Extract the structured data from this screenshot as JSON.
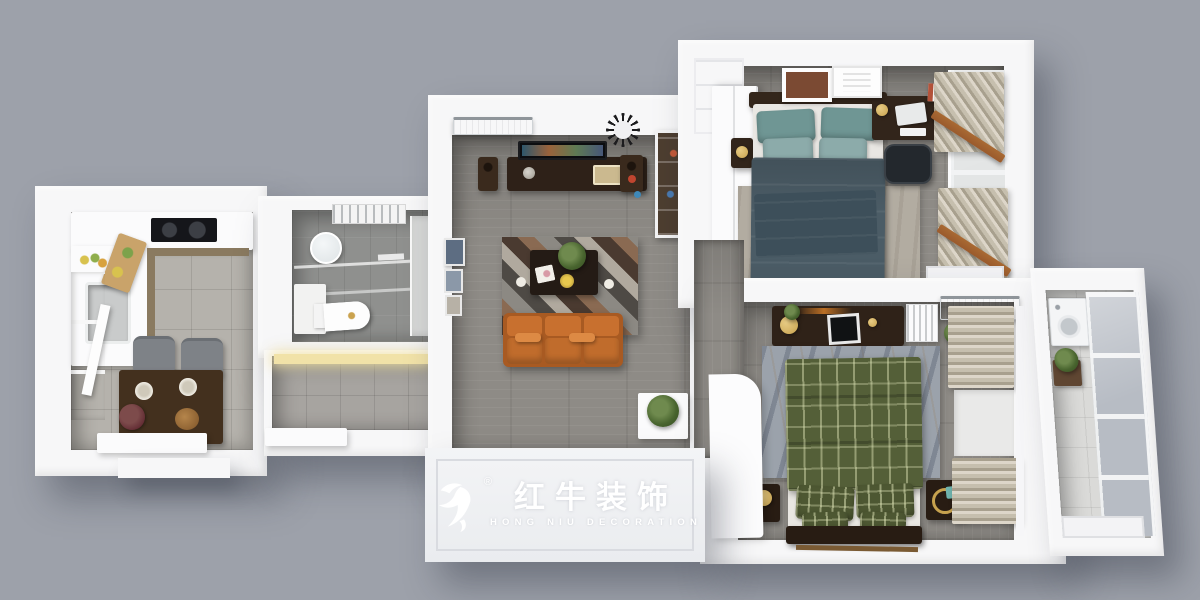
{
  "logo": {
    "brand_cn": "红牛装饰",
    "brand_en": "HONG NIU DECORATION",
    "registered_mark": "®",
    "icon": "bull-swoosh-icon"
  },
  "colors": {
    "bg": "#9da1aa",
    "wall": "#f7f7f8",
    "slab": "#eff0f3",
    "wood_floor": "#8e8b86",
    "tile_floor": "#b5b2ac",
    "bath_floor": "#8f908e",
    "glass": "#b7bcc4",
    "curtain": "#c9c2b2",
    "sofa_orange": "#c8702f",
    "bed_teal": "#6f9694",
    "duvet_slate": "#4b5c66",
    "bed_green_plaid": "#545f38",
    "dark_wood": "#32251b",
    "wood_trim_orange": "#9a5a2c",
    "accent_gold": "#c7a24e",
    "logo_white": "#ffffff"
  }
}
